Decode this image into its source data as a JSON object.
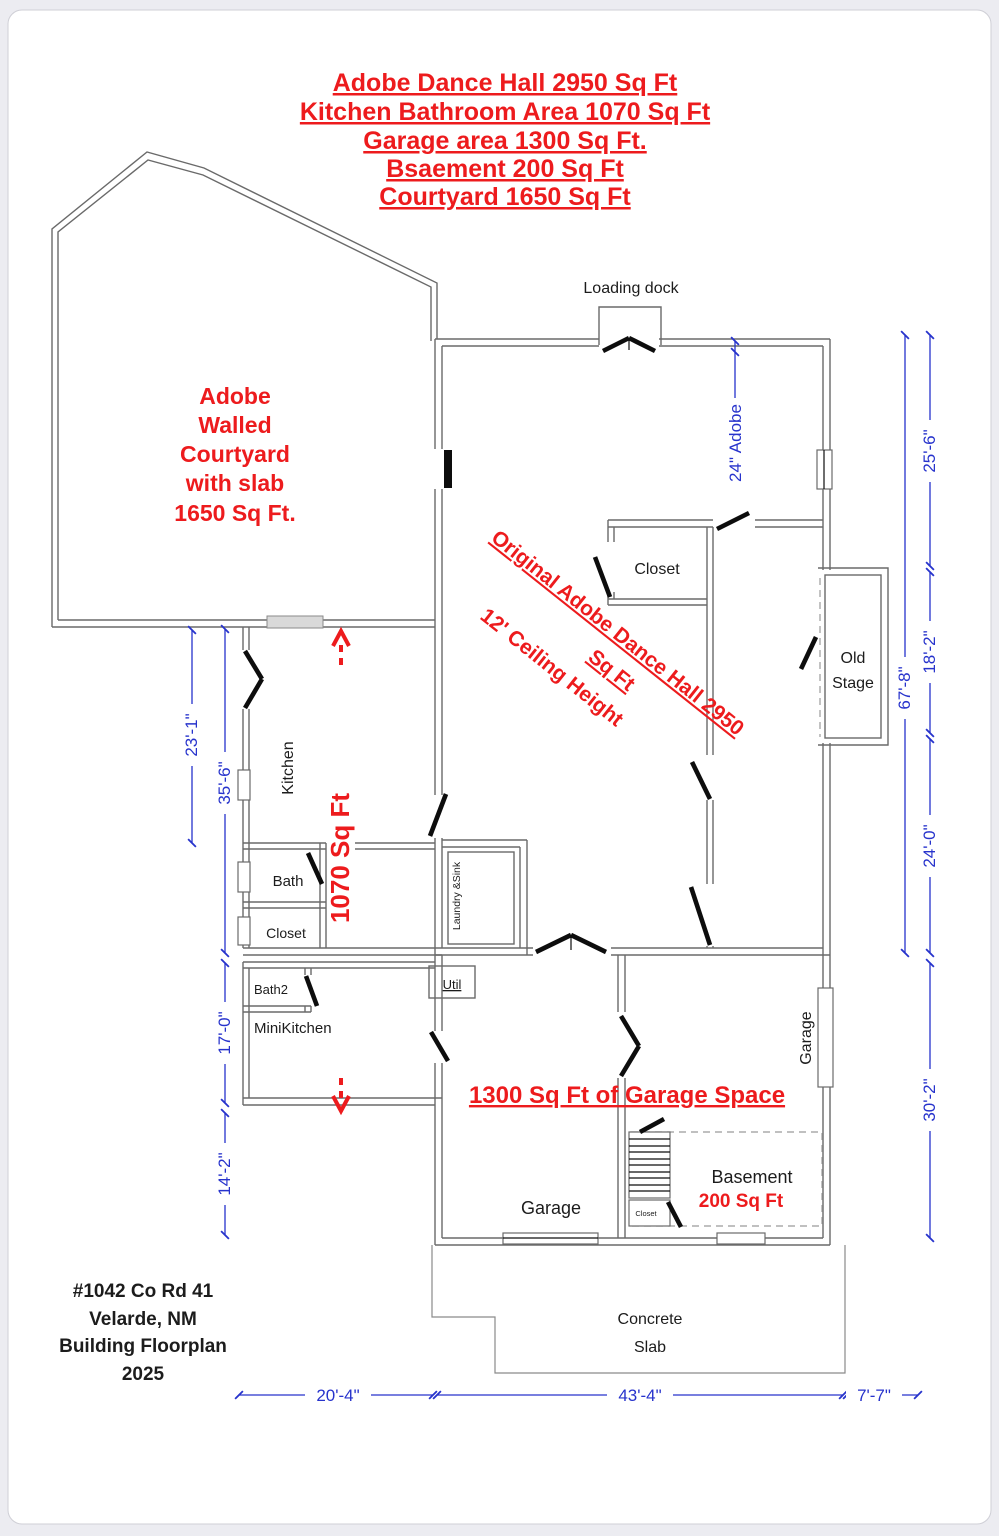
{
  "header": {
    "lines": [
      "Adobe Dance Hall 2950 Sq Ft",
      "Kitchen Bathroom Area 1070 Sq Ft",
      "Garage area 1300 Sq Ft.",
      "Bsaement 200 Sq Ft",
      "Courtyard 1650 Sq Ft"
    ]
  },
  "courtyard": {
    "lines": [
      "Adobe",
      "Walled",
      "Courtyard",
      "with slab",
      "1650 Sq Ft."
    ]
  },
  "hall": {
    "line1": "Original Adobe Dance Hall  2950",
    "line2": "Sq Ft",
    "line3": "12' Ceiling Height",
    "loading_dock": "Loading dock",
    "closet": "Closet",
    "old_stage": [
      "Old",
      "Stage"
    ],
    "wall_note": "24\" Adobe",
    "laundry": "Laundry &Sink"
  },
  "kitchen": {
    "label": "Kitchen",
    "area": "1070 Sq Ft",
    "bath": "Bath",
    "closet": "Closet"
  },
  "lower": {
    "bath2": "Bath2",
    "minikitchen": "MiniKitchen",
    "util": "Util"
  },
  "garage": {
    "headline": "1300 Sq Ft of Garage Space",
    "label_left": "Garage",
    "label_right": "Garage",
    "basement": "Basement",
    "basement_area": "200 Sq Ft",
    "stairs_closet": "Closet"
  },
  "slab": {
    "lines": [
      "Concrete",
      "Slab"
    ]
  },
  "dims": {
    "d23": "23'-1\"",
    "d35": "35'-6\"",
    "d17": "17'-0\"",
    "d14": "14'-2\"",
    "d67": "67'-8\"",
    "d25": "25'-6\"",
    "d18": "18'-2\"",
    "d24": "24'-0\"",
    "d30": "30'-2\"",
    "b20": "20'-4\"",
    "b43": "43'-4\"",
    "b7": "7'-7\""
  },
  "footer": {
    "lines": [
      "#1042 Co Rd 41",
      "Velarde, NM",
      "Building Floorplan",
      "2025"
    ]
  },
  "colors": {
    "annotation_red": "#ed1b1d",
    "dimension_blue": "#2733cc",
    "wall_gray": "#6a6a6a"
  }
}
